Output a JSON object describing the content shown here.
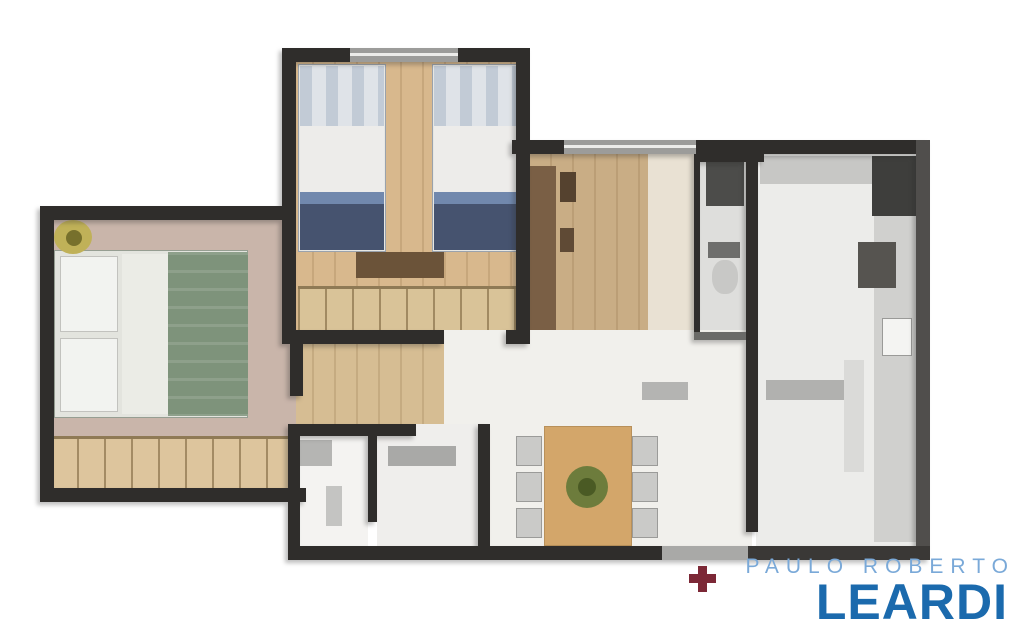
{
  "canvas": {
    "width": 1024,
    "height": 640,
    "background": "#ffffff"
  },
  "watermark": {
    "line1": "PAULO ROBERTO",
    "line2": "LEARDI",
    "line1_color": "#7aa9d8",
    "line2_color": "#1b6aad"
  },
  "palette": {
    "wall": "#2f2d2b",
    "wall_light": "#504e4c",
    "window": "#9c9c9a",
    "wood_floor": "#d8b88d",
    "living_floor": "#f1f0ec",
    "marker_red": "#7c2836"
  },
  "shapes": [
    {
      "layer": "floor",
      "name": "bedroom1-floor",
      "x": 290,
      "y": 58,
      "w": 236,
      "h": 278,
      "fill": "#d8b88d",
      "cls": "vlines"
    },
    {
      "layer": "floor",
      "name": "entry-hall-wood-floor",
      "x": 528,
      "y": 148,
      "w": 122,
      "h": 196,
      "fill": "#c9ad85",
      "cls": "vlines"
    },
    {
      "layer": "floor",
      "name": "entry-hall-light-floor",
      "x": 648,
      "y": 148,
      "w": 52,
      "h": 196,
      "fill": "#e9e1d3"
    },
    {
      "layer": "floor",
      "name": "service-room-floor",
      "x": 700,
      "y": 148,
      "w": 52,
      "h": 188,
      "fill": "#dededc"
    },
    {
      "layer": "floor",
      "name": "kitchen-floor",
      "x": 756,
      "y": 148,
      "w": 164,
      "h": 400,
      "fill": "#ececea"
    },
    {
      "layer": "floor",
      "name": "living-room-floor",
      "x": 440,
      "y": 330,
      "w": 312,
      "h": 220,
      "fill": "#f1f0ec"
    },
    {
      "layer": "floor",
      "name": "corridor-floor",
      "x": 290,
      "y": 336,
      "w": 154,
      "h": 96,
      "fill": "#d6bd93",
      "cls": "vlines"
    },
    {
      "layer": "floor",
      "name": "master-bedroom-floor",
      "x": 46,
      "y": 214,
      "w": 250,
      "h": 226,
      "fill": "#c9b5aa"
    },
    {
      "layer": "floor",
      "name": "master-bedroom-wardrobe",
      "x": 50,
      "y": 436,
      "w": 246,
      "h": 54,
      "fill": "#ddc59d",
      "cls": "vlines2"
    },
    {
      "layer": "floor",
      "name": "bathroom-left-floor",
      "x": 300,
      "y": 436,
      "w": 68,
      "h": 112,
      "fill": "#f4f3f1"
    },
    {
      "layer": "floor",
      "name": "bathroom-right-floor",
      "x": 377,
      "y": 424,
      "w": 101,
      "h": 124,
      "fill": "#efeeec"
    },
    {
      "layer": "furn",
      "name": "single-bed-left-frame",
      "x": 298,
      "y": 64,
      "w": 88,
      "h": 188,
      "fill": "#e7e7e3",
      "border": "#9aa2ac"
    },
    {
      "layer": "furn",
      "name": "single-bed-left-pillow",
      "x": 300,
      "y": 66,
      "w": 84,
      "h": 60,
      "fill": "#dfe3e8",
      "cls": "pillowtex"
    },
    {
      "layer": "furn",
      "name": "single-bed-left-sheet",
      "x": 300,
      "y": 126,
      "w": 84,
      "h": 66,
      "fill": "#edecea"
    },
    {
      "layer": "furn",
      "name": "single-bed-left-blanket-fold",
      "x": 300,
      "y": 192,
      "w": 84,
      "h": 12,
      "fill": "#7188ad"
    },
    {
      "layer": "furn",
      "name": "single-bed-left-blanket",
      "x": 300,
      "y": 204,
      "w": 84,
      "h": 46,
      "fill": "#46536f"
    },
    {
      "layer": "furn",
      "name": "single-bed-right-frame",
      "x": 432,
      "y": 64,
      "w": 88,
      "h": 188,
      "fill": "#e7e7e3",
      "border": "#9aa2ac"
    },
    {
      "layer": "furn",
      "name": "single-bed-right-pillow",
      "x": 434,
      "y": 66,
      "w": 84,
      "h": 60,
      "fill": "#dfe3e8",
      "cls": "pillowtex"
    },
    {
      "layer": "furn",
      "name": "single-bed-right-sheet",
      "x": 434,
      "y": 126,
      "w": 84,
      "h": 66,
      "fill": "#edecea"
    },
    {
      "layer": "furn",
      "name": "single-bed-right-blanket-fold",
      "x": 434,
      "y": 192,
      "w": 84,
      "h": 12,
      "fill": "#7188ad"
    },
    {
      "layer": "furn",
      "name": "single-bed-right-blanket",
      "x": 434,
      "y": 204,
      "w": 84,
      "h": 46,
      "fill": "#46536f"
    },
    {
      "layer": "furn",
      "name": "bedroom1-dresser",
      "x": 356,
      "y": 252,
      "w": 88,
      "h": 26,
      "fill": "#6b5339"
    },
    {
      "layer": "furn",
      "name": "bedroom1-wardrobe",
      "x": 298,
      "y": 286,
      "w": 220,
      "h": 44,
      "fill": "#d9c398",
      "cls": "vlines2"
    },
    {
      "layer": "furn",
      "name": "double-bed-frame",
      "x": 54,
      "y": 250,
      "w": 194,
      "h": 168,
      "fill": "#e3e4de",
      "border": "#969e92"
    },
    {
      "layer": "furn",
      "name": "double-bed-pillow-top",
      "x": 60,
      "y": 256,
      "w": 58,
      "h": 76,
      "fill": "#f2f3f0",
      "border": "#c2c2be"
    },
    {
      "layer": "furn",
      "name": "double-bed-pillow-bottom",
      "x": 60,
      "y": 338,
      "w": 58,
      "h": 74,
      "fill": "#f2f3f0",
      "border": "#c2c2be"
    },
    {
      "layer": "furn",
      "name": "double-bed-sheet",
      "x": 122,
      "y": 254,
      "w": 46,
      "h": 160,
      "fill": "#ebece6"
    },
    {
      "layer": "furn",
      "name": "double-bed-duvet",
      "x": 168,
      "y": 252,
      "w": 80,
      "h": 164,
      "fill": "#7e937b",
      "cls": "duvettex"
    },
    {
      "layer": "furn",
      "name": "master-bedroom-plant",
      "x": 54,
      "y": 220,
      "w": 38,
      "h": 34,
      "fill": "#c0b158",
      "radius": "50%"
    },
    {
      "layer": "furn",
      "name": "master-bedroom-plant-core",
      "x": 66,
      "y": 230,
      "w": 16,
      "h": 16,
      "fill": "#77702c",
      "radius": "50%"
    },
    {
      "layer": "furn",
      "name": "bathroom-shower-unit",
      "x": 300,
      "y": 440,
      "w": 32,
      "h": 26,
      "fill": "#b5b5b3"
    },
    {
      "layer": "furn",
      "name": "bathroom-fixture",
      "x": 326,
      "y": 486,
      "w": 16,
      "h": 40,
      "fill": "#c4c4c2"
    },
    {
      "layer": "furn",
      "name": "bathroom-vanity",
      "x": 388,
      "y": 446,
      "w": 68,
      "h": 20,
      "fill": "#a9a9a7"
    },
    {
      "layer": "furn",
      "name": "entry-sideboard",
      "x": 530,
      "y": 166,
      "w": 26,
      "h": 164,
      "fill": "#7a5f45"
    },
    {
      "layer": "furn",
      "name": "entry-decor-vase-1",
      "x": 560,
      "y": 172,
      "w": 16,
      "h": 30,
      "fill": "#55422f"
    },
    {
      "layer": "furn",
      "name": "entry-decor-vase-2",
      "x": 560,
      "y": 228,
      "w": 14,
      "h": 24,
      "fill": "#5f4a35"
    },
    {
      "layer": "furn",
      "name": "tv-console",
      "x": 642,
      "y": 382,
      "w": 46,
      "h": 18,
      "fill": "#b4b4b2"
    },
    {
      "layer": "furn",
      "name": "dining-chair-1",
      "x": 516,
      "y": 436,
      "w": 26,
      "h": 30,
      "fill": "#cacac8",
      "border": "#9b9b99"
    },
    {
      "layer": "furn",
      "name": "dining-chair-2",
      "x": 516,
      "y": 472,
      "w": 26,
      "h": 30,
      "fill": "#cacac8",
      "border": "#9b9b99"
    },
    {
      "layer": "furn",
      "name": "dining-chair-3",
      "x": 516,
      "y": 508,
      "w": 26,
      "h": 30,
      "fill": "#cacac8",
      "border": "#9b9b99"
    },
    {
      "layer": "furn",
      "name": "dining-chair-4",
      "x": 632,
      "y": 436,
      "w": 26,
      "h": 30,
      "fill": "#cacac8",
      "border": "#9b9b99"
    },
    {
      "layer": "furn",
      "name": "dining-chair-5",
      "x": 632,
      "y": 472,
      "w": 26,
      "h": 30,
      "fill": "#cacac8",
      "border": "#9b9b99"
    },
    {
      "layer": "furn",
      "name": "dining-chair-6",
      "x": 632,
      "y": 508,
      "w": 26,
      "h": 30,
      "fill": "#cacac8",
      "border": "#9b9b99"
    },
    {
      "layer": "furn",
      "name": "dining-table",
      "x": 544,
      "y": 426,
      "w": 88,
      "h": 120,
      "fill": "#d3a66a",
      "border": "#b8905a"
    },
    {
      "layer": "furn",
      "name": "dining-centerpiece",
      "x": 566,
      "y": 466,
      "w": 42,
      "h": 42,
      "fill": "#6d7c3c",
      "radius": "50%"
    },
    {
      "layer": "furn",
      "name": "dining-centerpiece-core",
      "x": 578,
      "y": 478,
      "w": 18,
      "h": 18,
      "fill": "#4a5a24",
      "radius": "50%"
    },
    {
      "layer": "furn",
      "name": "kitchen-top-counter",
      "x": 760,
      "y": 156,
      "w": 114,
      "h": 28,
      "fill": "#c7c7c5"
    },
    {
      "layer": "furn",
      "name": "kitchen-right-counter",
      "x": 874,
      "y": 156,
      "w": 44,
      "h": 386,
      "fill": "#d0d0ce"
    },
    {
      "layer": "furn",
      "name": "kitchen-fridge",
      "x": 872,
      "y": 156,
      "w": 46,
      "h": 60,
      "fill": "#3e3e3c"
    },
    {
      "layer": "furn",
      "name": "kitchen-stove",
      "x": 858,
      "y": 242,
      "w": 38,
      "h": 46,
      "fill": "#565450"
    },
    {
      "layer": "furn",
      "name": "kitchen-sink",
      "x": 882,
      "y": 318,
      "w": 30,
      "h": 38,
      "fill": "#f4f4f2",
      "border": "#9a9a98"
    },
    {
      "layer": "furn",
      "name": "kitchen-island-counter",
      "x": 766,
      "y": 380,
      "w": 78,
      "h": 20,
      "fill": "#b1b1af"
    },
    {
      "layer": "furn",
      "name": "kitchen-counter-strip",
      "x": 844,
      "y": 360,
      "w": 20,
      "h": 112,
      "fill": "#dadad8"
    },
    {
      "layer": "furn",
      "name": "service-shelf-unit",
      "x": 706,
      "y": 162,
      "w": 38,
      "h": 44,
      "fill": "#4c4c4a"
    },
    {
      "layer": "furn",
      "name": "service-toilet-tank",
      "x": 708,
      "y": 242,
      "w": 32,
      "h": 16,
      "fill": "#6e6e6c"
    },
    {
      "layer": "furn",
      "name": "service-toilet-bowl",
      "x": 712,
      "y": 260,
      "w": 26,
      "h": 34,
      "fill": "#c8c8c6",
      "radius": "45%"
    },
    {
      "layer": "wall",
      "name": "wall-bedroom1-top",
      "x": 282,
      "y": 48,
      "w": 248,
      "h": 14,
      "fill": "#2f2d2b"
    },
    {
      "layer": "wall",
      "name": "wall-bedroom1-left",
      "x": 282,
      "y": 48,
      "w": 14,
      "h": 296,
      "fill": "#2f2d2b"
    },
    {
      "layer": "wall",
      "name": "wall-bedroom1-right",
      "x": 516,
      "y": 48,
      "w": 14,
      "h": 296,
      "fill": "#2f2d2b"
    },
    {
      "layer": "wall",
      "name": "wall-bedroom1-bottom-left",
      "x": 282,
      "y": 330,
      "w": 162,
      "h": 14,
      "fill": "#2f2d2b"
    },
    {
      "layer": "wall",
      "name": "wall-bedroom1-bottom-right",
      "x": 506,
      "y": 330,
      "w": 24,
      "h": 14,
      "fill": "#2f2d2b"
    },
    {
      "layer": "wall",
      "name": "wall-master-top",
      "x": 40,
      "y": 206,
      "w": 250,
      "h": 14,
      "fill": "#2f2d2b"
    },
    {
      "layer": "wall",
      "name": "wall-master-left",
      "x": 40,
      "y": 206,
      "w": 14,
      "h": 296,
      "fill": "#2f2d2b"
    },
    {
      "layer": "wall",
      "name": "wall-master-bottom",
      "x": 40,
      "y": 488,
      "w": 266,
      "h": 14,
      "fill": "#2f2d2b"
    },
    {
      "layer": "wall",
      "name": "wall-master-right-stub",
      "x": 290,
      "y": 344,
      "w": 13,
      "h": 52,
      "fill": "#2f2d2b"
    },
    {
      "layer": "wall",
      "name": "wall-bathroom-left",
      "x": 288,
      "y": 424,
      "w": 12,
      "h": 136,
      "fill": "#2f2d2b"
    },
    {
      "layer": "wall",
      "name": "wall-bathroom-top",
      "x": 288,
      "y": 424,
      "w": 128,
      "h": 12,
      "fill": "#2f2d2b"
    },
    {
      "layer": "wall",
      "name": "wall-bathroom-right",
      "x": 478,
      "y": 424,
      "w": 12,
      "h": 136,
      "fill": "#2f2d2b"
    },
    {
      "layer": "wall",
      "name": "wall-bathroom-divider",
      "x": 368,
      "y": 436,
      "w": 9,
      "h": 86,
      "fill": "#2f2d2b"
    },
    {
      "layer": "wall",
      "name": "wall-right-section-top",
      "x": 512,
      "y": 140,
      "w": 418,
      "h": 14,
      "fill": "#2f2d2b"
    },
    {
      "layer": "wall",
      "name": "wall-service-top-thick",
      "x": 694,
      "y": 140,
      "w": 70,
      "h": 22,
      "fill": "#2f2d2b"
    },
    {
      "layer": "wall",
      "name": "wall-service-left",
      "x": 694,
      "y": 148,
      "w": 6,
      "h": 188,
      "fill": "#2f2d2b"
    },
    {
      "layer": "wall",
      "name": "wall-service-bottom",
      "x": 694,
      "y": 332,
      "w": 60,
      "h": 8,
      "fill": "#6a6a68"
    },
    {
      "layer": "wall",
      "name": "wall-living-kitchen-divider",
      "x": 746,
      "y": 148,
      "w": 12,
      "h": 384,
      "fill": "#2f2d2b"
    },
    {
      "layer": "wall",
      "name": "wall-right-exterior",
      "x": 916,
      "y": 140,
      "w": 14,
      "h": 420,
      "fill": "#504e4c"
    },
    {
      "layer": "wall",
      "name": "wall-bottom-left",
      "x": 288,
      "y": 546,
      "w": 374,
      "h": 14,
      "fill": "#2f2d2b"
    },
    {
      "layer": "wall",
      "name": "wall-bottom-sliding-door",
      "x": 662,
      "y": 546,
      "w": 86,
      "h": 14,
      "fill": "#a9a9a7"
    },
    {
      "layer": "wall",
      "name": "wall-bottom-kitchen",
      "x": 748,
      "y": 546,
      "w": 182,
      "h": 14,
      "fill": "#3a3836"
    },
    {
      "layer": "over",
      "name": "window-bedroom1",
      "x": 350,
      "y": 48,
      "w": 108,
      "h": 14,
      "fill": "#9c9c9a"
    },
    {
      "layer": "over",
      "name": "window-bedroom1-glass-line",
      "x": 350,
      "y": 53,
      "w": 108,
      "h": 3,
      "fill": "#ececea"
    },
    {
      "layer": "over",
      "name": "window-hall",
      "x": 564,
      "y": 140,
      "w": 132,
      "h": 14,
      "fill": "#9c9c9a"
    },
    {
      "layer": "over",
      "name": "window-hall-glass-line",
      "x": 564,
      "y": 145,
      "w": 132,
      "h": 3,
      "fill": "#ececea"
    },
    {
      "layer": "over",
      "name": "entrance-marker-cross-v",
      "x": 698,
      "y": 566,
      "w": 9,
      "h": 26,
      "fill": "#7c2836"
    },
    {
      "layer": "over",
      "name": "entrance-marker-cross-h",
      "x": 689,
      "y": 574,
      "w": 27,
      "h": 9,
      "fill": "#7c2836"
    }
  ]
}
